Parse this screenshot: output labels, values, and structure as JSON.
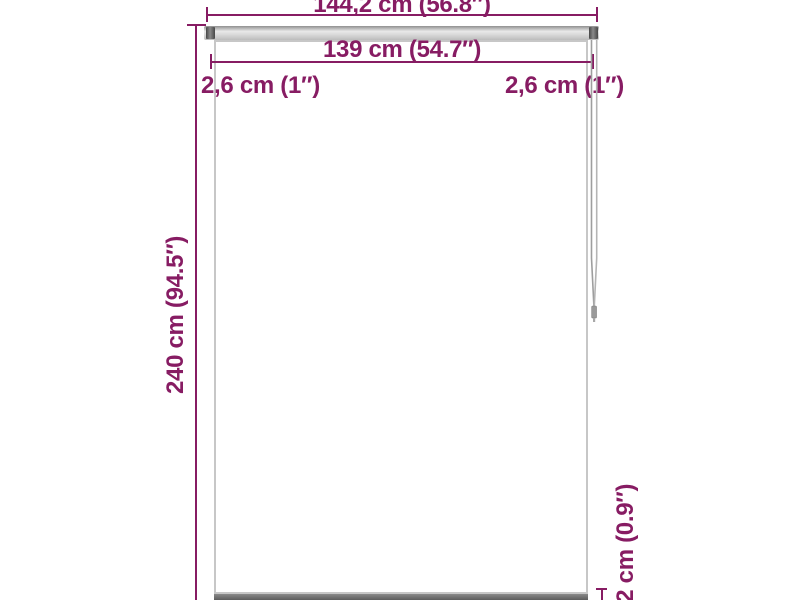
{
  "diagram": {
    "type": "product-dimension-diagram",
    "labels": {
      "total_width": "144,2 cm (56.8″)",
      "fabric_width": "139 cm (54.7″)",
      "left_gap": "2,6 cm (1″)",
      "right_gap": "2,6 cm (1″)",
      "height": "240 cm (94.5″)",
      "bottom_bar_depth": "2,2 cm (0.9″)"
    },
    "colors": {
      "dimension_annotation": "#871c63",
      "fabric_border": "#c7c7c7",
      "top_bar": "#d9d9d9",
      "bracket": "#474747",
      "bottom_bar": "#6a6a6a",
      "cord": "#a8a8a8",
      "background": "#ffffff"
    }
  }
}
